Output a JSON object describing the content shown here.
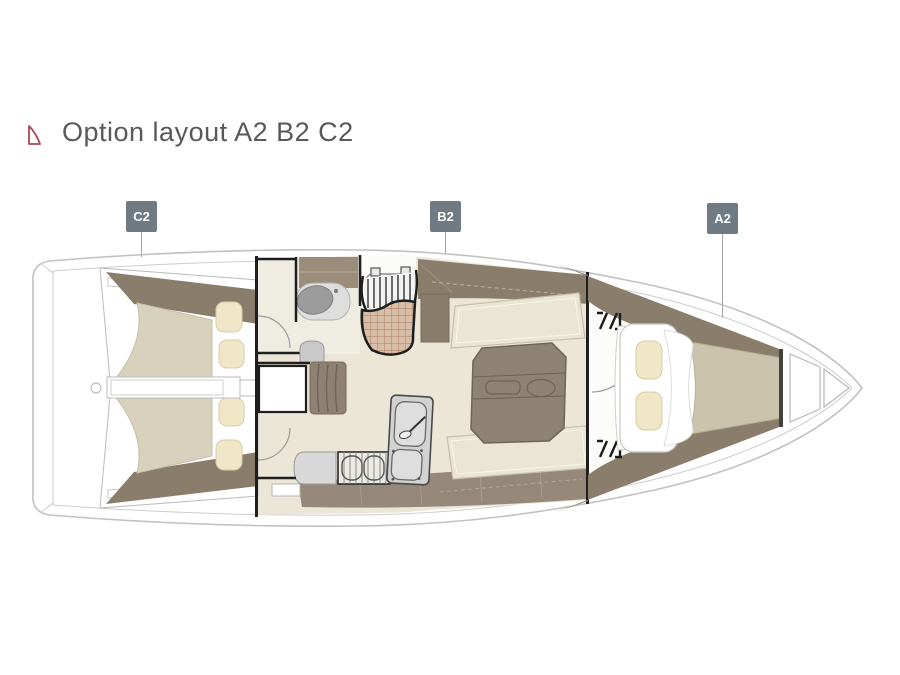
{
  "page": {
    "background": "#ffffff"
  },
  "header": {
    "title": "Option layout A2 B2 C2",
    "title_color": "#58595b",
    "icon": "sailboat-icon",
    "icon_color": "#a84750"
  },
  "badges": {
    "style": {
      "background": "#6f7a83",
      "text_color": "#ffffff",
      "leader_line_color": "#a0a6aa"
    },
    "items": [
      {
        "label": "C2",
        "points_to": "aft-twin-cabins"
      },
      {
        "label": "B2",
        "points_to": "salon-galley"
      },
      {
        "label": "A2",
        "points_to": "forward-v-berth-cabin"
      }
    ]
  },
  "diagram": {
    "type": "sailboat-interior-floorplan",
    "orientation": "bow-right",
    "sections": [
      "aft-cabin-port",
      "aft-cabin-starboard",
      "stern-divider",
      "head-compartment",
      "companionway-steps",
      "entry-floor-grate",
      "nav-station",
      "galley",
      "salon-settee-port",
      "salon-settee-starboard",
      "salon-table",
      "forward-v-berth-cabin",
      "anchor-locker"
    ],
    "colors": {
      "hull_outline": "#c2c2c2",
      "floor": "#ece6d7",
      "wood_dark": "#8b7d6c",
      "wood_mid": "#97897a",
      "tan_cabinet": "#9b8c7b",
      "mattress": "#d8d1bc",
      "mattress_forward": "#cbc3ab",
      "pillow": "#f0e7c9",
      "table": "#8e8275",
      "appliance_gray": "#d2d2d2",
      "sink_basin": "#9c9c9c",
      "wall": "#1e1e1e",
      "tile": "#d8bda7",
      "tile_line": "#aa8166"
    }
  }
}
